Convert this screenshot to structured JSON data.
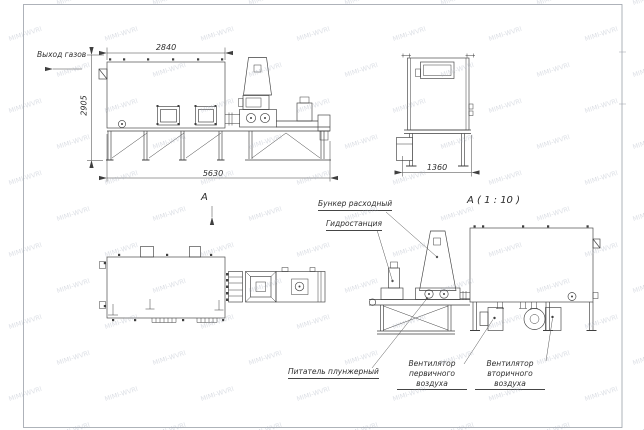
{
  "watermark": {
    "text": "MIMI-WVRI"
  },
  "drawing": {
    "side_view": {
      "gas_outlet_label": "Выход газов",
      "dim_width_top": "2840",
      "dim_height": "2905",
      "dim_length": "5630"
    },
    "end_view": {
      "dim_width": "1360"
    },
    "plan_view": {
      "view_label": "А"
    },
    "detail_view": {
      "title": "А ( 1 : 10 )",
      "callouts": {
        "hopper": "Бункер расходный",
        "hydraulic_station": "Гидростанция",
        "plunger_feeder": "Питатель плунжерный",
        "primary_air_fan": "Вентилятор\nпервичного воздуха",
        "secondary_air_fan": "Вентилятор\nвторичного воздуха"
      }
    }
  }
}
